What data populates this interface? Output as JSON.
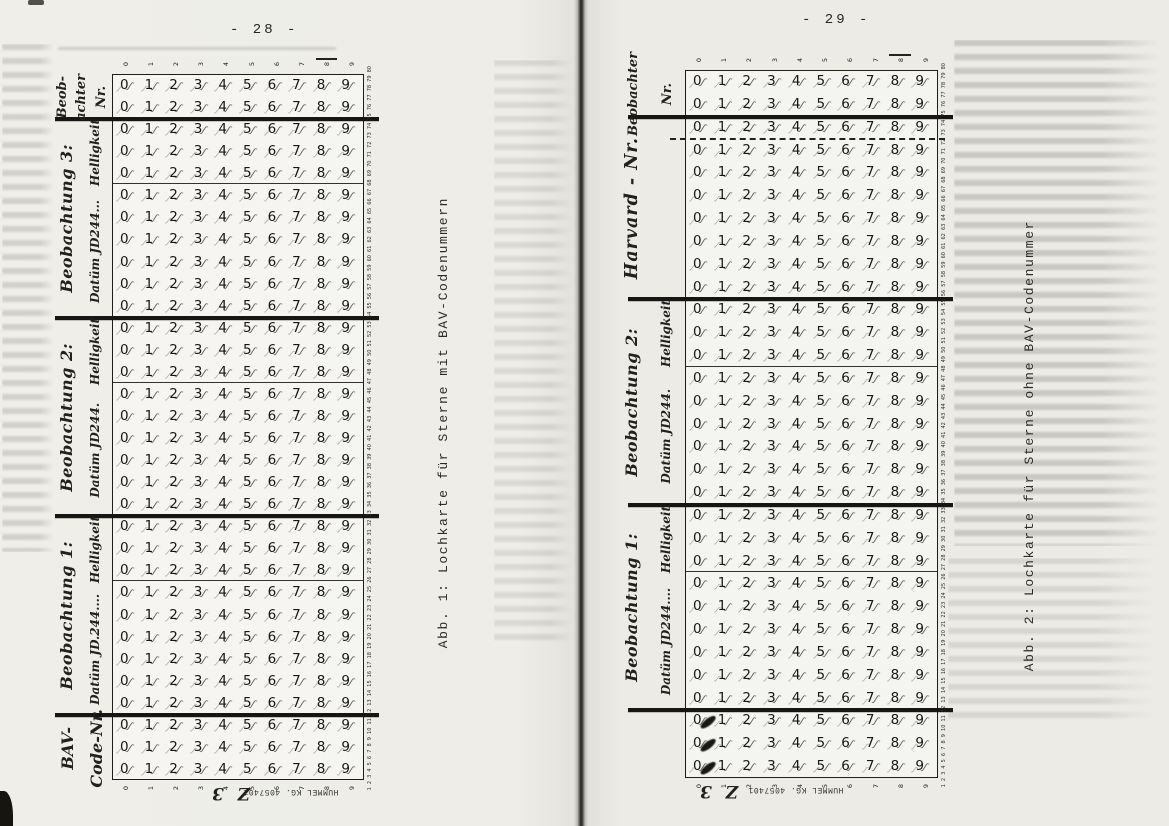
{
  "document": {
    "pages": [
      {
        "side": "left",
        "page_number": "- 28 -",
        "caption": "Abb. 1: Lochkarte für Sterne mit BAV-Codenummern",
        "card": {
          "digits": [
            "0",
            "1",
            "2",
            "3",
            "4",
            "5",
            "6",
            "7",
            "8",
            "9"
          ],
          "edge_digits_top": [
            "0",
            "1",
            "2",
            "3",
            "4",
            "5",
            "6",
            "7",
            "8",
            "9"
          ],
          "edge_digits_bottom": [
            "0",
            "1",
            "2",
            "3",
            "4",
            "5",
            "6",
            "7",
            "8",
            "9"
          ],
          "column_numbers": {
            "from": 1,
            "to": 80
          },
          "maker_imprint": "HUMMEL KG. 4057401",
          "edge_note": "Z 3",
          "rows_total": 32,
          "sections": [
            {
              "name": "beobachter-nr",
              "rows": 2,
              "divider_after": "thick",
              "punched": false
            },
            {
              "name": "beobachtung-3-helligkeit",
              "rows": 3,
              "divider_after": "thin",
              "punched": false
            },
            {
              "name": "beobachtung-3-datum",
              "rows": 6,
              "divider_after": "thick",
              "punched": false
            },
            {
              "name": "beobachtung-2-helligkeit",
              "rows": 3,
              "divider_after": "thin",
              "punched": false
            },
            {
              "name": "beobachtung-2-datum",
              "rows": 6,
              "divider_after": "thick",
              "punched": false
            },
            {
              "name": "beobachtung-1-helligkeit",
              "rows": 3,
              "divider_after": "thin",
              "punched": false
            },
            {
              "name": "beobachtung-1-datum",
              "rows": 6,
              "divider_after": "thick",
              "punched": false
            },
            {
              "name": "bav-code-nr",
              "rows": 3,
              "divider_after": null,
              "punched": false
            }
          ],
          "labels": [
            {
              "name": "beobachter-nr",
              "row_start": 0,
              "rows": 2,
              "lines": [
                "Beob-",
                "achter",
                "Nr."
              ]
            },
            {
              "name": "beobachtung-3",
              "row_start": 2,
              "rows": 9,
              "main": "Beobachtung 3:",
              "field_top": "Helligkeit",
              "field_bottom": "Datüm JD244..."
            },
            {
              "name": "beobachtung-2",
              "row_start": 11,
              "rows": 9,
              "main": "Beobachtung 2:",
              "field_top": "Helligkeit",
              "field_bottom": "Datüm JD244."
            },
            {
              "name": "beobachtung-1",
              "row_start": 20,
              "rows": 9,
              "main": "Beobachtung 1:",
              "field_top": "Helligkeit",
              "field_bottom": "Datüm JD.244...."
            },
            {
              "name": "bav-code-nr",
              "row_start": 29,
              "rows": 3,
              "lines": [
                "BAV-",
                "Code-Nr."
              ]
            }
          ]
        }
      },
      {
        "side": "right",
        "page_number": "- 29 -",
        "caption": "Abb. 2: Lochkarte für Sterne ohne BAV-Codenummer",
        "card": {
          "digits": [
            "0",
            "1",
            "2",
            "3",
            "4",
            "5",
            "6",
            "7",
            "8",
            "9"
          ],
          "edge_digits_top": [
            "0",
            "1",
            "2",
            "3",
            "4",
            "5",
            "6",
            "7",
            "8",
            "9"
          ],
          "edge_digits_bottom": [
            "0",
            "1",
            "2",
            "3",
            "4",
            "5",
            "6",
            "7",
            "8",
            "9"
          ],
          "column_numbers": {
            "from": 1,
            "to": 80
          },
          "maker_imprint": "HUMMEL KG. 4057401",
          "edge_note": "Z 3",
          "rows_total": 31,
          "sections": [
            {
              "name": "beobachter-nr",
              "rows": 2,
              "divider_after": "thick",
              "punched": false
            },
            {
              "name": "harvard-nr-zone",
              "rows": 1,
              "divider_after": "dashed",
              "punched": false
            },
            {
              "name": "harvard-nr",
              "rows": 7,
              "divider_after": "thick",
              "punched": false
            },
            {
              "name": "beobachtung-2-helligkeit",
              "rows": 3,
              "divider_after": "thin",
              "punched": false
            },
            {
              "name": "beobachtung-2-datum",
              "rows": 6,
              "divider_after": "thick",
              "punched": false
            },
            {
              "name": "beobachtung-1-helligkeit",
              "rows": 3,
              "divider_after": "thin",
              "punched": false
            },
            {
              "name": "beobachtung-1-datum",
              "rows": 6,
              "divider_after": "thick",
              "punched": false
            },
            {
              "name": "punched-rows",
              "rows": 3,
              "divider_after": null,
              "punched": true
            }
          ],
          "labels": [
            {
              "name": "beobachter-nr",
              "row_start": 0,
              "rows": 2,
              "lines": [
                "Beobachter",
                "Nr."
              ]
            },
            {
              "name": "harvard-nr",
              "row_start": 2,
              "rows": 8,
              "main": "Harvard - Nr."
            },
            {
              "name": "beobachtung-2",
              "row_start": 10,
              "rows": 9,
              "main": "Beobachtung 2:",
              "field_top": "Helligkeit",
              "field_bottom": "Datüm JD244."
            },
            {
              "name": "beobachtung-1",
              "row_start": 19,
              "rows": 9,
              "main": "Beobachtung 1:",
              "field_top": "Helligkeit",
              "field_bottom": "Datüm JD244...."
            }
          ]
        }
      }
    ]
  }
}
